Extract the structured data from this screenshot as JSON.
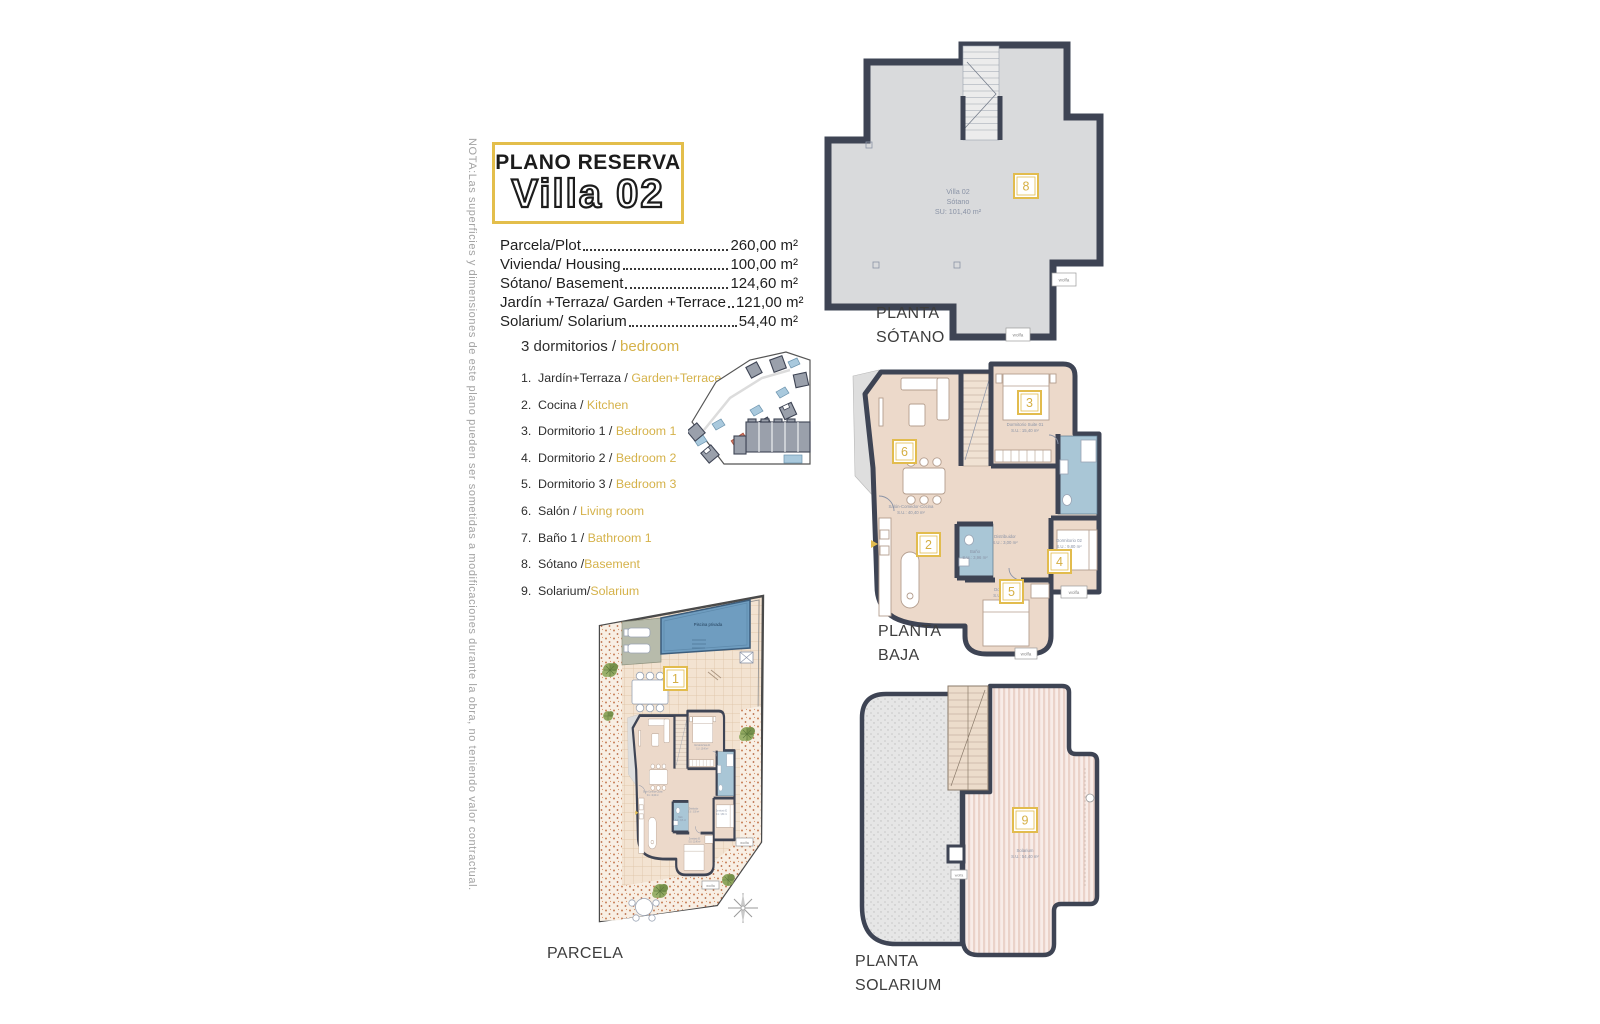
{
  "note": "NOTA:Las superficies y dimensiones de este plano pueden ser sometidas a modificaciones durante la obra, no teniendo valor contractual.",
  "title": {
    "kicker": "PLANO RESERVA",
    "name": "Villa 02"
  },
  "areas": [
    {
      "label": "Parcela/Plot",
      "value": "260,00 m²"
    },
    {
      "label": "Vivienda/ Housing",
      "value": "100,00 m²"
    },
    {
      "label": "Sótano/ Basement",
      "value": "124,60 m²"
    },
    {
      "label": "Jardín +Terraza/ Garden +Terrace",
      "value": "121,00 m²"
    },
    {
      "label": "Solarium/ Solarium",
      "value": "54,40 m²"
    }
  ],
  "legend": {
    "header_es": "3 dormitorios /",
    "header_en": "bedroom",
    "items": [
      {
        "num": "1.",
        "es": "Jardín+Terraza /",
        "en": "Garden+Terrace"
      },
      {
        "num": "2.",
        "es": "Cocina /",
        "en": "Kitchen"
      },
      {
        "num": "3.",
        "es": "Dormitorio 1 /",
        "en": "Bedroom 1"
      },
      {
        "num": "4.",
        "es": "Dormitorio 2 /",
        "en": "Bedroom 2"
      },
      {
        "num": "5.",
        "es": "Dormitorio 3 /",
        "en": "Bedroom 3"
      },
      {
        "num": "6.",
        "es": "Salón /",
        "en": "Living room"
      },
      {
        "num": "7.",
        "es": "Baño 1 /",
        "en": "Bathroom 1"
      },
      {
        "num": "8.",
        "es": "Sótano /",
        "en": "Basement"
      },
      {
        "num": "9.",
        "es": "Solarium/",
        "en": "Solarium"
      }
    ]
  },
  "plans": {
    "sotano": {
      "label1": "PLANTA",
      "label2": "SÓTANO",
      "badge": "8",
      "room_line1": "Villa 02",
      "room_line2": "Sótano",
      "room_line3": "SU: 101,40 m²"
    },
    "baja": {
      "label1": "PLANTA",
      "label2": "BAJA",
      "badge_kitchen": "2",
      "badge_bedroom1": "3",
      "badge_bedroom2": "4",
      "badge_bedroom3": "5",
      "badge_living": "6",
      "rooms": {
        "living": {
          "name": "Salón-Comedor-Cocina",
          "area": "S.U.: 40,40 m²"
        },
        "suite": {
          "name": "Dormitorio Suite 01",
          "area": "S.U.: 15,40 m²"
        },
        "bedroom2": {
          "name": "Dormitorio 02",
          "area": "S.U.: 9,80 m²"
        },
        "bedroom3": {
          "name": "Dormitorio 03",
          "area": "S.U.: 11,40 m²"
        },
        "bath": {
          "name": "Baño",
          "area": "S.U.: 3,96 m²"
        },
        "hall": {
          "name": "Distribuidor",
          "area": "S.U.: 3,00 m²"
        }
      }
    },
    "parcela": {
      "label": "PARCELA",
      "badge": "1",
      "pool_label": "Piscina privada"
    },
    "solarium": {
      "label1": "PLANTA",
      "label2": "SOLARIUM",
      "badge": "9",
      "room_name": "Solarium",
      "room_area": "S.U.: 54,40 m²"
    }
  },
  "brand": {
    "watermark": "wolfa"
  },
  "colors": {
    "accent": "#E3BE4B",
    "wall": "#3E4454",
    "floor": "#ECD9CA",
    "basement_fill": "#D9DADC",
    "bath_blue": "#A9C6D6",
    "pool_blue": "#6F9DC0",
    "highlight_salmon": "#E08873",
    "text_dark": "#1D1D1B",
    "plan_text": "#8A93A6"
  }
}
